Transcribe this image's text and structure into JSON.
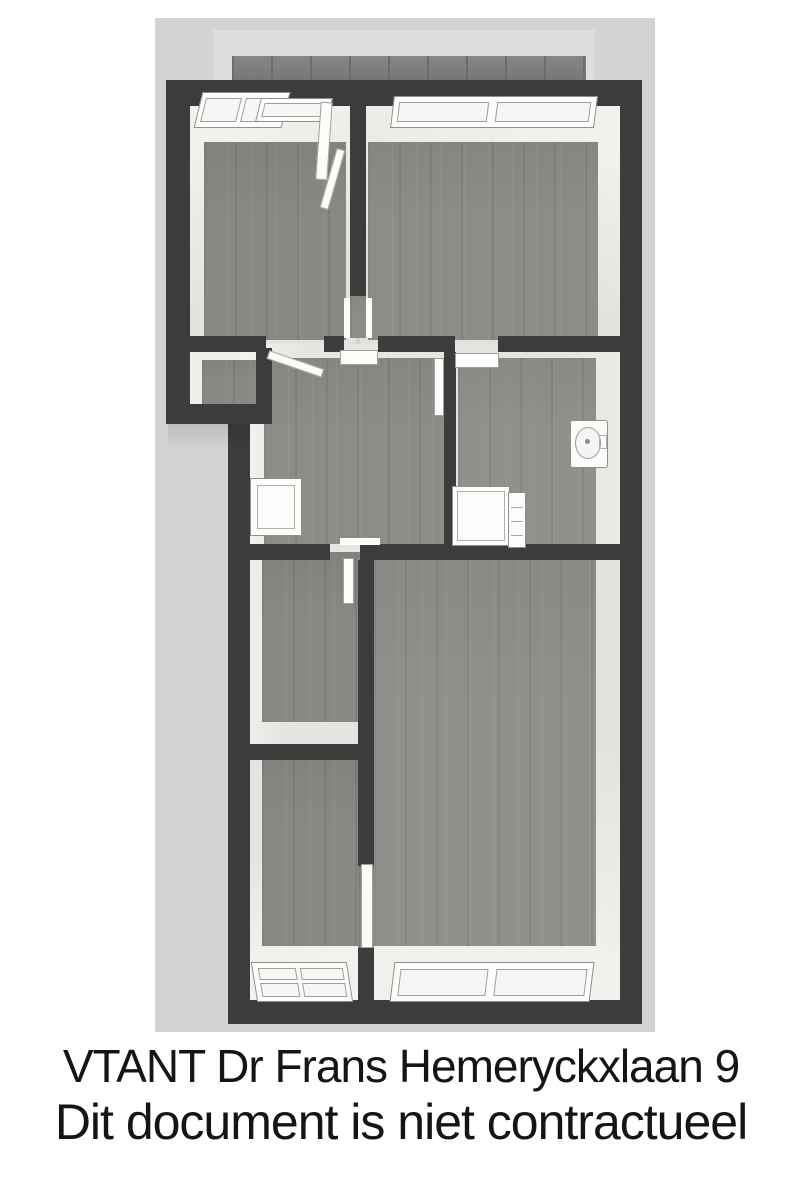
{
  "caption": {
    "line1": "VTANT Dr Frans Hemeryckxlaan 9",
    "line2": "Dit document is niet contractueel"
  },
  "floorplan": {
    "view": "top-down 3D floor plan render",
    "rooms_visible": 8,
    "fixtures": [
      "window",
      "door",
      "toilet",
      "shower",
      "washbasin"
    ]
  },
  "colors": {
    "page_background": "#ffffff",
    "canvas_background": "#d3d3d2",
    "upper_backdrop": "#dedddb",
    "roof_strip": "#7c7c7a",
    "walls": "#3c3c3c",
    "floor_wood": "#8d8d88",
    "inner_wall_face": "#eceae6",
    "fixture_white": "#fcfcfb",
    "caption_text": "#151515"
  }
}
